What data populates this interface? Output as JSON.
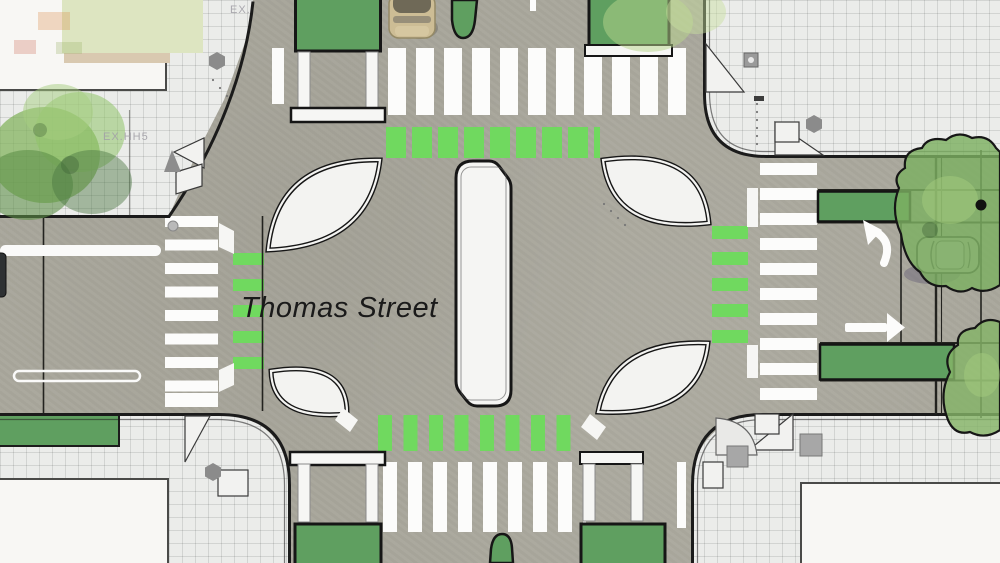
{
  "title": "Thomas Street",
  "labels": {
    "street_name": "Thomas Street",
    "existing_utility_note": "EX.HH5",
    "existing_note_short": "EX."
  },
  "colors": {
    "road": "#a9a79c",
    "sidewalk": "#ebecea",
    "building": "#f8f7f4",
    "lawn": "#dde5c1",
    "curb": "#1b1b1b",
    "planter_green": "#5f9f60",
    "bike_crossing_green": "#70d95f",
    "crosswalk_white": "#fcfcfb",
    "island_white": "#f3f3f1",
    "tree_green": "#7cb061",
    "car_tan": "#cdbd95",
    "car_silver": "#b4b6ae"
  },
  "icons": {
    "turn_arrow": "curved-turn-arrow-icon",
    "straight_arrow": "straight-arrow-icon",
    "hexagon_marker": "hexagon-utility-icon",
    "tree": "tree-canopy-icon",
    "car": "car-top-view-icon"
  },
  "features": {
    "crosswalks": [
      "north",
      "south",
      "east",
      "west"
    ],
    "bike_crossings": [
      "north",
      "south",
      "east",
      "west"
    ],
    "corner_islands": 4,
    "center_median": 1,
    "median_noses": 2,
    "transit_islands": 4,
    "green_bike_lane_boxes": 2,
    "cars": 2
  }
}
